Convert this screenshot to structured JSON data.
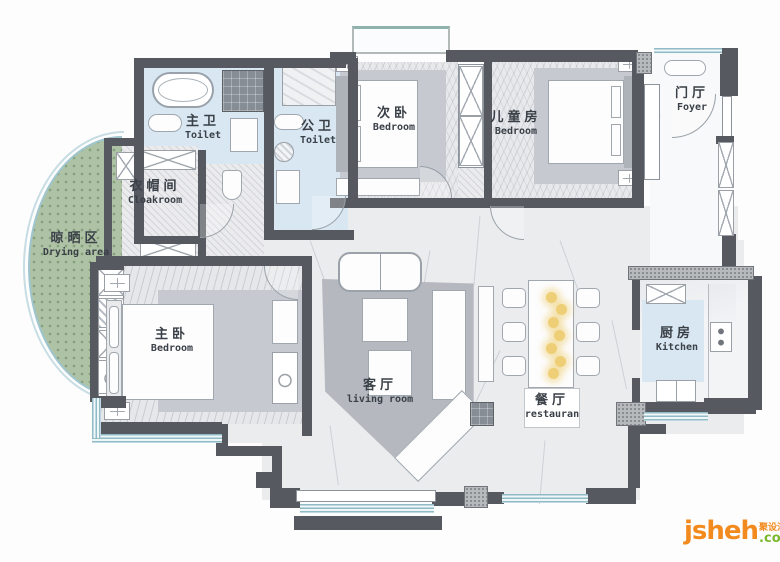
{
  "rooms": [
    {
      "id": "master-toilet",
      "zh": "主卫",
      "en": "Toilet"
    },
    {
      "id": "public-toilet",
      "zh": "公卫",
      "en": "Toilet"
    },
    {
      "id": "second-bedroom",
      "zh": "次卧",
      "en": "Bedroom"
    },
    {
      "id": "children-room",
      "zh": "儿童房",
      "en": "Bedroom"
    },
    {
      "id": "foyer",
      "zh": "门厅",
      "en": "Foyer"
    },
    {
      "id": "cloakroom",
      "zh": "衣帽间",
      "en": "Cloakroom"
    },
    {
      "id": "drying-area",
      "zh": "晾晒区",
      "en": "Drying area"
    },
    {
      "id": "master-bedroom",
      "zh": "主卧",
      "en": "Bedroom"
    },
    {
      "id": "living-room",
      "zh": "客厅",
      "en": "living room"
    },
    {
      "id": "dining-room",
      "zh": "餐厅",
      "en": "restauran"
    },
    {
      "id": "kitchen",
      "zh": "厨房",
      "en": "Kitchen"
    }
  ],
  "watermark": {
    "brand": "jsheh",
    "cn": "聚设汇",
    "tld": ".com"
  },
  "colors": {
    "wall": "#565a60",
    "bath_floor": "#d9e7f3",
    "drying_green": "#aec2a5",
    "rug_gray": "#b5b9bf",
    "window_blue": "#9fc5cf",
    "flower_yellow": "#eecf77",
    "brand_orange": "#f28a1e",
    "brand_green": "#7ab82d"
  }
}
